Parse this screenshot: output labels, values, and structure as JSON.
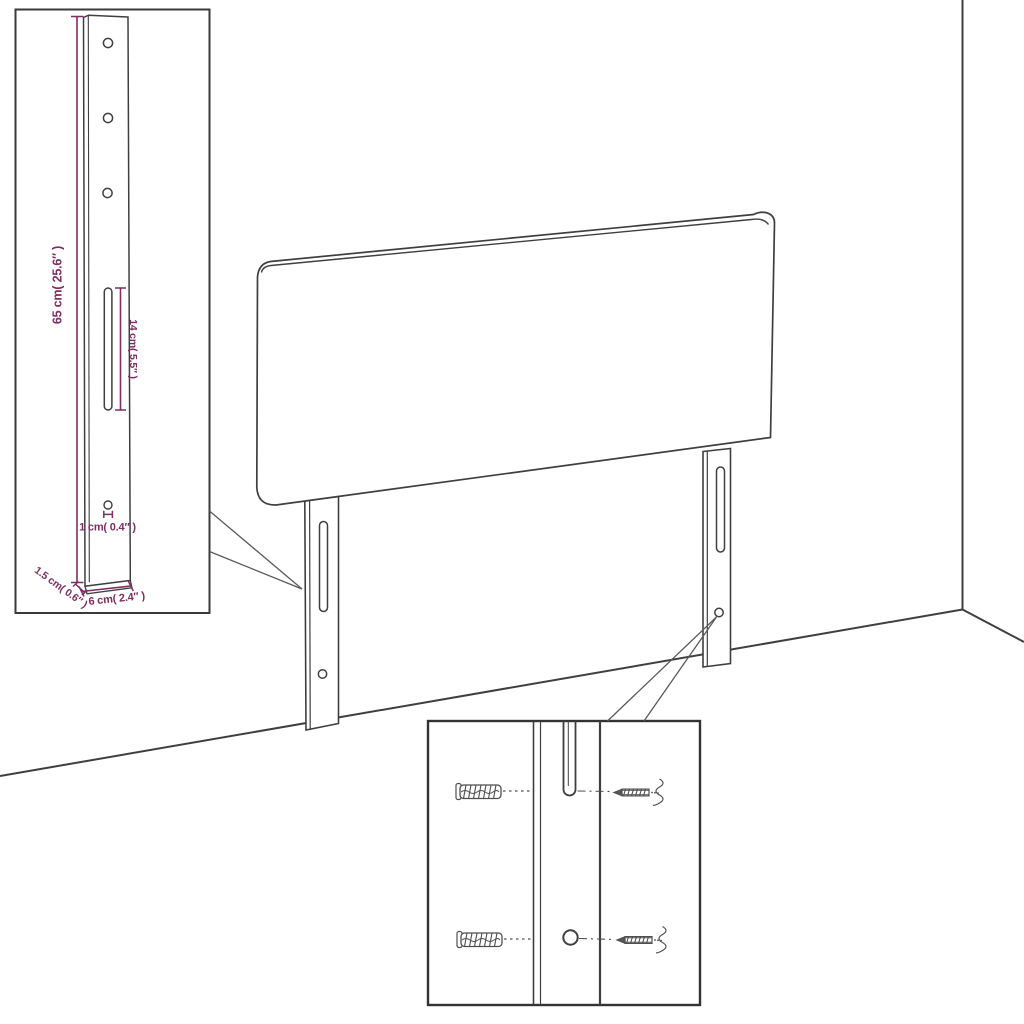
{
  "diagram": {
    "title": "headboard-dimension-diagram",
    "inset_bracket": {
      "height_label": "65 cm( 25.6″ )",
      "slot_label": "14 cm( 5.5″ )",
      "hole_label": "1 cm( 0.4″ )",
      "depth_label": "1.5 cm( 0.6″ )",
      "width_label": "6 cm( 2.4″ )"
    },
    "icons": {
      "wall_plug": "wall-plug-icon",
      "screw": "screw-icon"
    },
    "colors": {
      "dimension_accent": "#7e2e61",
      "line_art": "#3f3f3f",
      "background": "#ffffff"
    }
  }
}
